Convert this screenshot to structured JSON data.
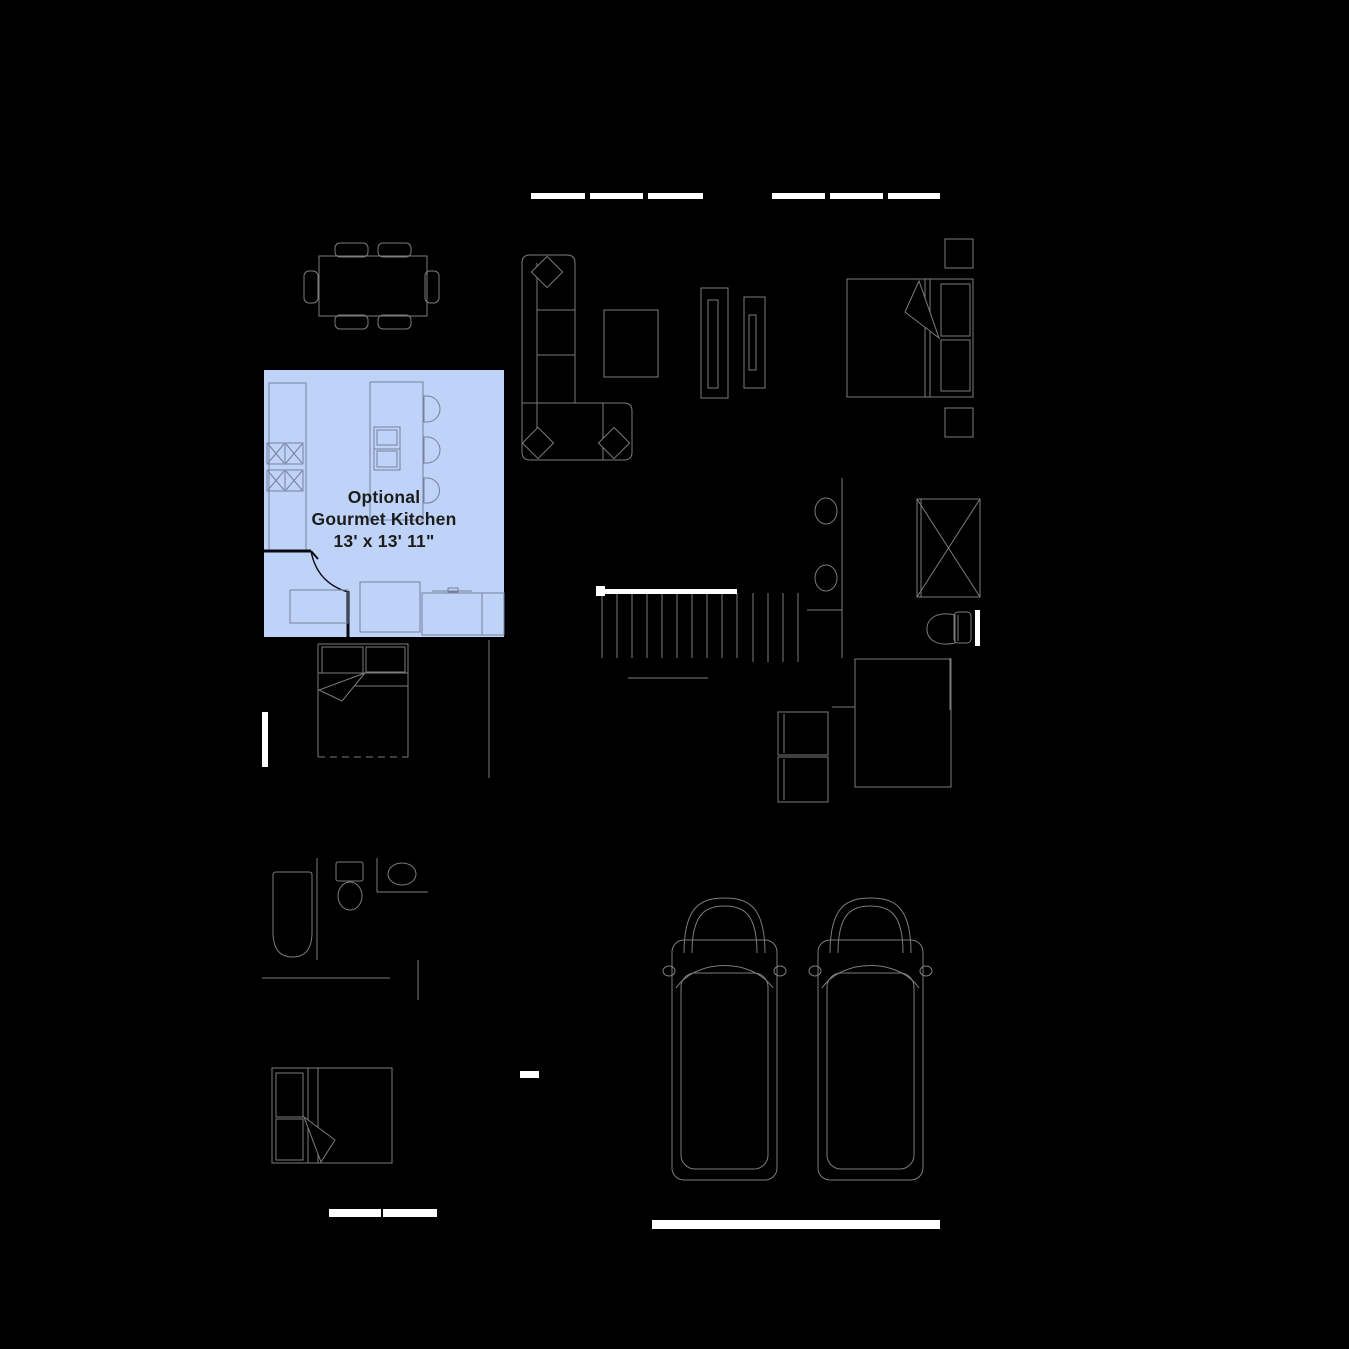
{
  "canvas": {
    "width": 1349,
    "height": 1349
  },
  "colors": {
    "background": "#000000",
    "furniture_line": "#7b7c80",
    "kitchen_highlight": "#bfd3f8",
    "kitchen_line": "#76809c",
    "door_line": "#0a0a12",
    "window_fill": "#ffffff",
    "label_text": "#1c1c1c"
  },
  "kitchen_label": {
    "line1": "Optional",
    "line2": "Gourmet Kitchen",
    "line3": "13' x 13' 11\""
  },
  "symbols": [
    "dining-table",
    "dining-chair",
    "sectional-sofa",
    "throw-pillow",
    "coffee-table",
    "tv-console",
    "media-cabinet",
    "double-bed",
    "pillow",
    "nightstand",
    "sheet-fold",
    "range-cooktop",
    "kitchen-counter",
    "kitchen-island",
    "island-sink",
    "bar-stool",
    "base-cabinet",
    "kitchen-door",
    "staircase",
    "stair-handrail",
    "double-vanity-sink",
    "shower",
    "toilet",
    "washer",
    "dryer",
    "closet",
    "bathtub",
    "corner-sink",
    "bed-window",
    "window",
    "garage-door",
    "car"
  ]
}
